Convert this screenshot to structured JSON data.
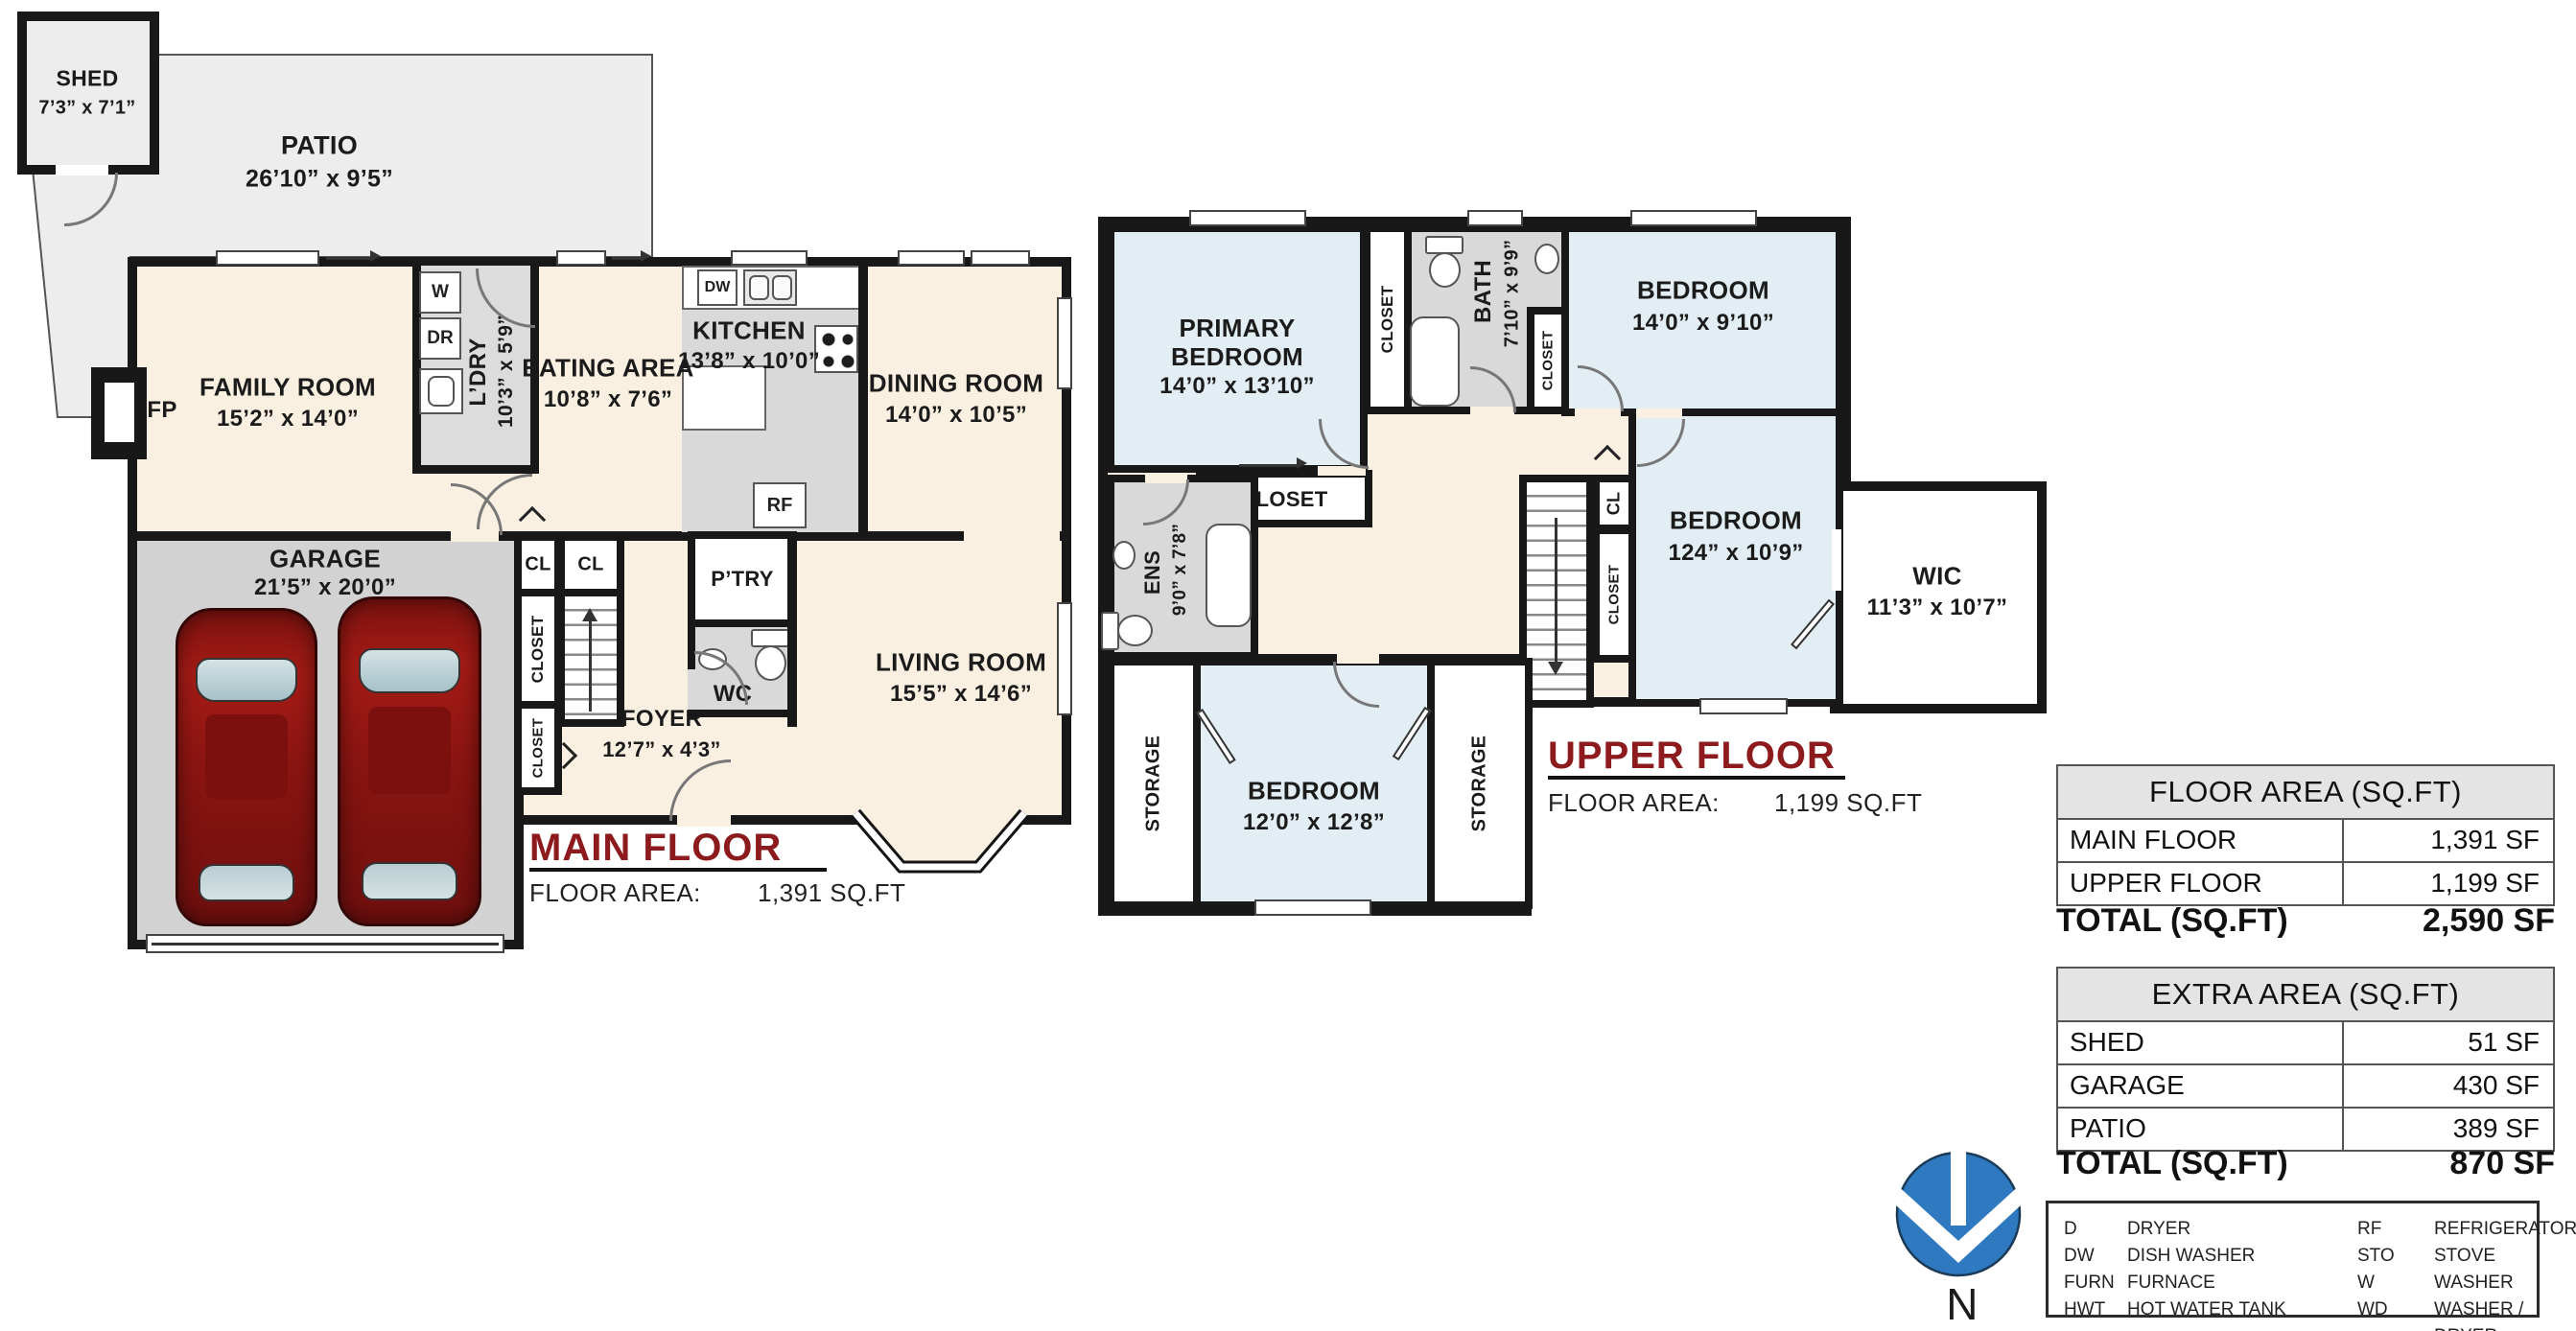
{
  "palette": {
    "cream": "#faf0e2",
    "gray_room": "#d9d9d9",
    "garage_gray": "#d2d2d2",
    "patio_gray": "#ededed",
    "bedroom_blue": "#e2edf4",
    "wall_black": "#181818",
    "title_red": "#8d1b1e",
    "car_red": "#8c1512",
    "compass_blue": "#2e79c0"
  },
  "main_floor": {
    "title": "MAIN FLOOR",
    "area_label": "FLOOR AREA:",
    "area_value": "1,391 SQ.FT",
    "shed": {
      "name": "SHED",
      "dims": "7’3” x 7’1”"
    },
    "patio": {
      "name": "PATIO",
      "dims": "26’10” x 9’5”"
    },
    "family": {
      "name": "FAMILY ROOM",
      "dims": "15’2” x 14’0”"
    },
    "ldry": {
      "name": "L’DRY",
      "dims": "10’3” x 5’9”"
    },
    "eating": {
      "name": "EATING AREA",
      "dims": "10’8” x 7’6”"
    },
    "kitchen": {
      "name": "KITCHEN",
      "dims": "13’8” x 10’0”"
    },
    "dining": {
      "name": "DINING ROOM",
      "dims": "14’0” x 10’5”"
    },
    "garage": {
      "name": "GARAGE",
      "dims": "21’5” x 20’0”"
    },
    "living": {
      "name": "LIVING ROOM",
      "dims": "15’5” x 14’6”"
    },
    "foyer": {
      "name": "FOYER",
      "dims": "12’7” x 4’3”"
    },
    "pantry": "P’TRY",
    "wc": "WC",
    "fp": "FP",
    "cl": "CL",
    "closet": "CLOSET",
    "appliances": {
      "w": "W",
      "dr": "DR",
      "dw": "DW",
      "rf": "RF"
    }
  },
  "upper_floor": {
    "title": "UPPER FLOOR",
    "area_label": "FLOOR AREA:",
    "area_value": "1,199 SQ.FT",
    "primary": {
      "name": "PRIMARY BEDROOM",
      "dims": "14’0” x 13’10”"
    },
    "bath": {
      "name": "BATH",
      "dims": "7’10” x 9’9”"
    },
    "bedroom_tr": {
      "name": "BEDROOM",
      "dims": "14’0” x 9’10”"
    },
    "ens": {
      "name": "ENS",
      "dims": "9’0” x 7’8”"
    },
    "bedroom_m": {
      "name": "BEDROOM",
      "dims": "124” x 10’9”"
    },
    "wic": {
      "name": "WIC",
      "dims": "11’3” x 10’7”"
    },
    "bedroom_b": {
      "name": "BEDROOM",
      "dims": "12’0” x 12’8”"
    },
    "storage": "STORAGE",
    "closet": "CLOSET",
    "cl": "CL"
  },
  "tables": {
    "floor_area": {
      "header": "FLOOR AREA (SQ.FT)",
      "rows": [
        {
          "label": "MAIN FLOOR",
          "value": "1,391 SF"
        },
        {
          "label": "UPPER FLOOR",
          "value": "1,199 SF"
        }
      ],
      "total_label": "TOTAL (SQ.FT)",
      "total_value": "2,590 SF"
    },
    "extra_area": {
      "header": "EXTRA AREA (SQ.FT)",
      "rows": [
        {
          "label": "SHED",
          "value": "51 SF"
        },
        {
          "label": "GARAGE",
          "value": "430 SF"
        },
        {
          "label": "PATIO",
          "value": "389 SF"
        }
      ],
      "total_label": "TOTAL (SQ.FT)",
      "total_value": "870 SF"
    }
  },
  "legend": {
    "items": [
      {
        "abbr": "D",
        "term": "DRYER"
      },
      {
        "abbr": "DW",
        "term": "DISH WASHER"
      },
      {
        "abbr": "FURN",
        "term": "FURNACE"
      },
      {
        "abbr": "HWT",
        "term": "HOT WATER TANK"
      },
      {
        "abbr": "RF",
        "term": "REFRIGERATOR"
      },
      {
        "abbr": "STO",
        "term": "STOVE"
      },
      {
        "abbr": "W",
        "term": "WASHER"
      },
      {
        "abbr": "WD",
        "term": "WASHER / DRYER"
      }
    ]
  },
  "compass": {
    "label": "N"
  }
}
